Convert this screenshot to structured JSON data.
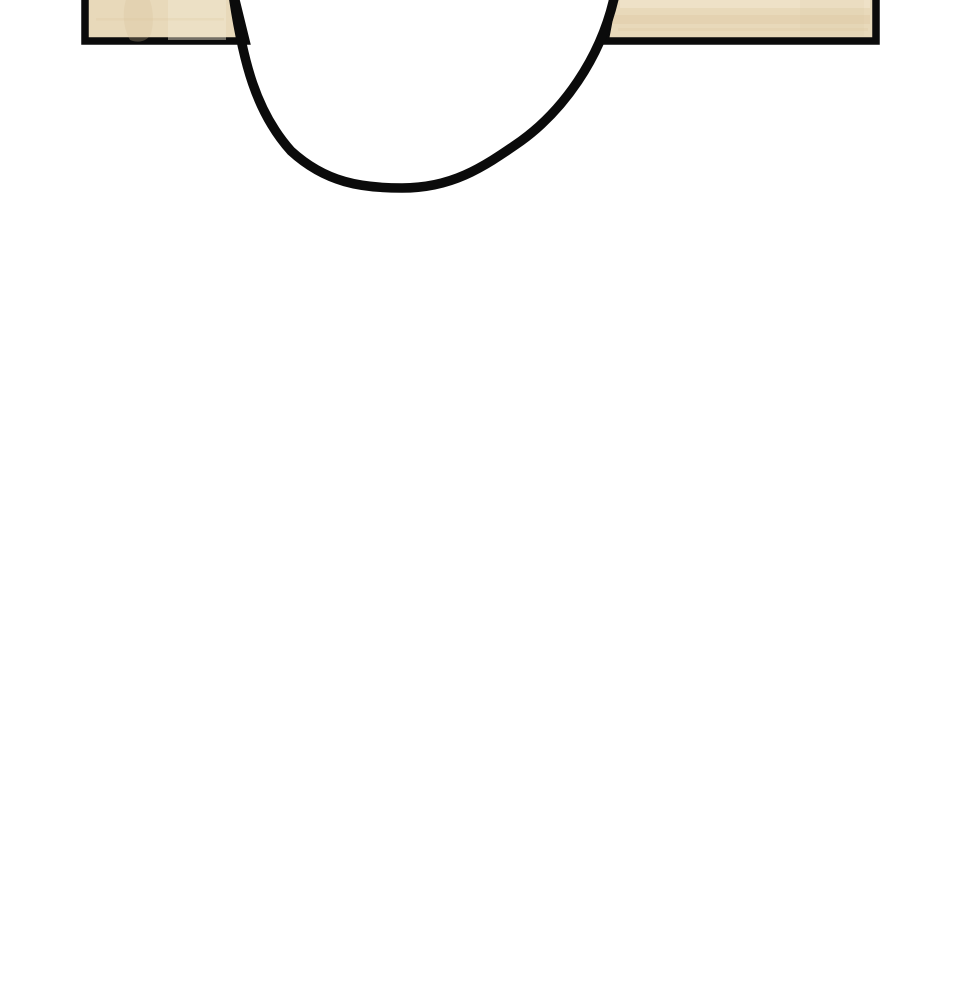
{
  "scene": {
    "description": "Comic-panel style close-up: two light wooden table-edge boards across the top of a white page, separated by a large thick black U-shaped outline (bottom of a round object) dipping down between them; remainder of the page is blank white.",
    "background": "white"
  },
  "colors": {
    "paper": "#ffffff",
    "ink": "#0b0b0b",
    "wood_base": "#e8d9ba",
    "wood_grain_dark": "#d9c29c",
    "wood_grain_light": "#f2e8d2"
  },
  "shapes": {
    "left_panel": {
      "label": "left wooden board",
      "path": "M 85 -12 L 233 -12 L 246 41 L 85 41 Z"
    },
    "left_panel_grain_blotch": {
      "path": "M 128 -6 C 122 8 122 26 130 40 C 140 44 148 40 151 34 C 156 14 150 -2 146 -8 Z"
    },
    "left_panel_sheen": {
      "path": "M 168 -6 h 58 v 46 h -58 Z"
    },
    "left_panel_grain_line": {
      "path": "M 96 18 h 128 v 2.5 h -128 Z"
    },
    "right_panel": {
      "label": "right wooden board",
      "path": "M 615 -12 L 876 -12 L 876 41 L 605 41 Z"
    },
    "right_panel_light_band": {
      "path": "M 620 -4 h 250 v 12 h -250 Z"
    },
    "right_panel_dark_band": {
      "path": "M 612 15 h 258 v 9 h -258 Z"
    },
    "right_panel_thin_line": {
      "path": "M 618 28 h 250 v 3 h -250 Z"
    },
    "right_panel_corner_shade": {
      "path": "M 800 0 h 64 v 36 h -64 Z"
    },
    "u_curve": {
      "label": "thick black U-shaped outline of round object",
      "path": "M 233 -6 C 243 62 256 112 291 151 C 326 183 362 188 402 188 C 451 188 481 169 521 141 C 561 112 601 60 615 -6"
    }
  }
}
